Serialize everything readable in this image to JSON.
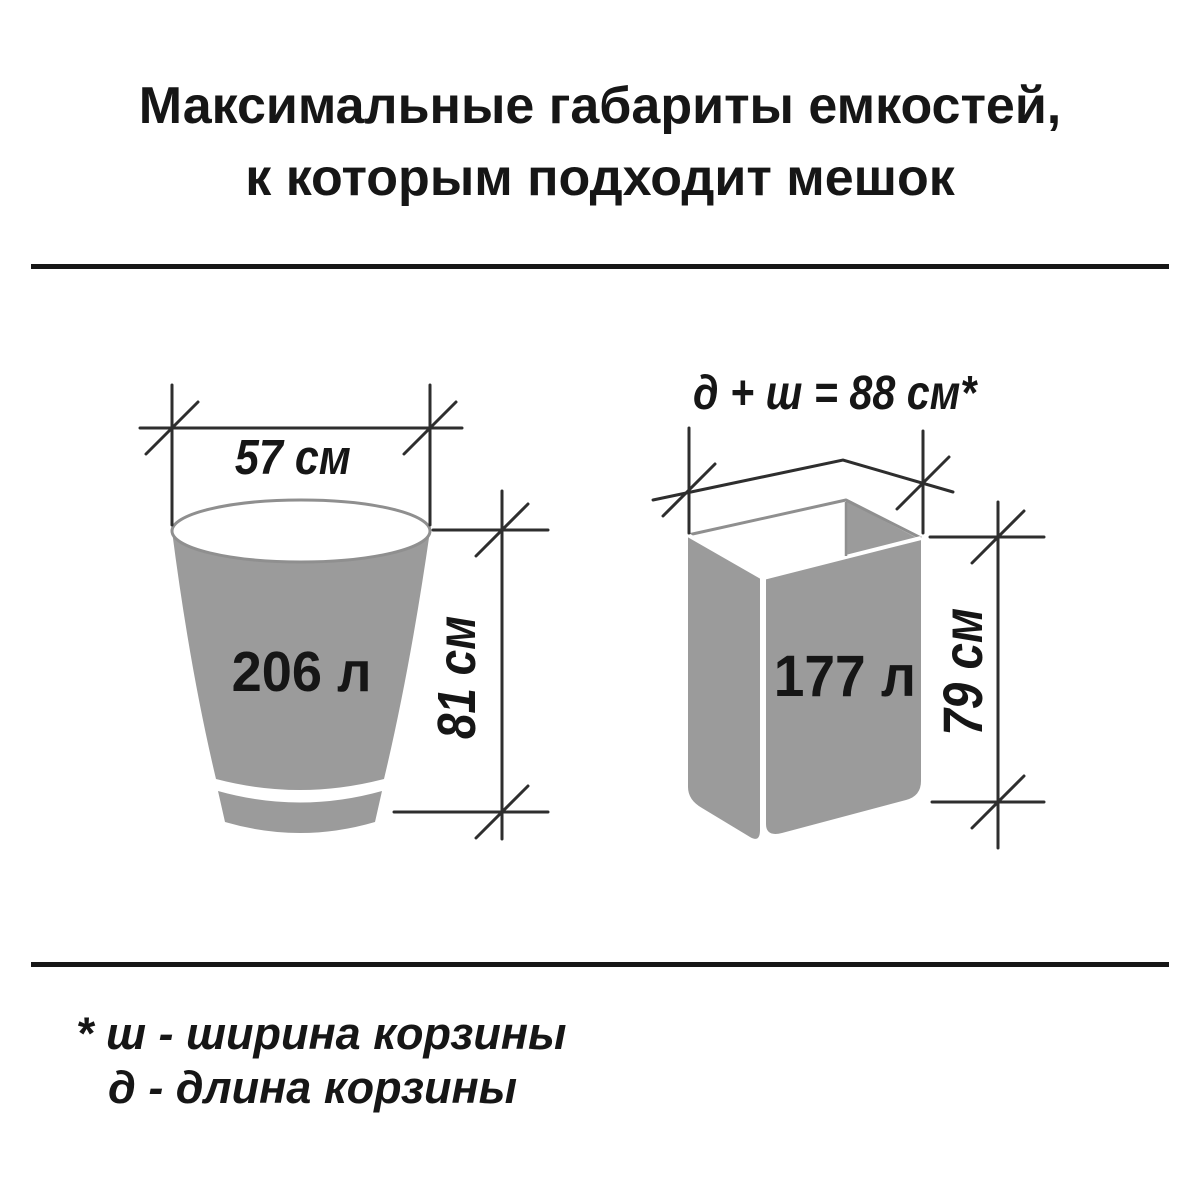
{
  "title": {
    "line1": "Максимальные габариты емкостей,",
    "line2": "к которым подходит мешок"
  },
  "bucket": {
    "width_label": "57 см",
    "height_label": "81 см",
    "volume_label": "206 л"
  },
  "basket": {
    "formula_label": "д + ш = 88 см*",
    "height_label": "79 см",
    "volume_label": "177 л"
  },
  "footnote": {
    "line1": "* ш - ширина корзины",
    "line2": "д - длина корзины"
  },
  "colors": {
    "container_gray": "#9b9b9b",
    "outline_gray": "#8f8f8f",
    "dimension_line": "#2e2e2e",
    "divider": "#161616",
    "text": "#161616",
    "background": "#ffffff"
  }
}
